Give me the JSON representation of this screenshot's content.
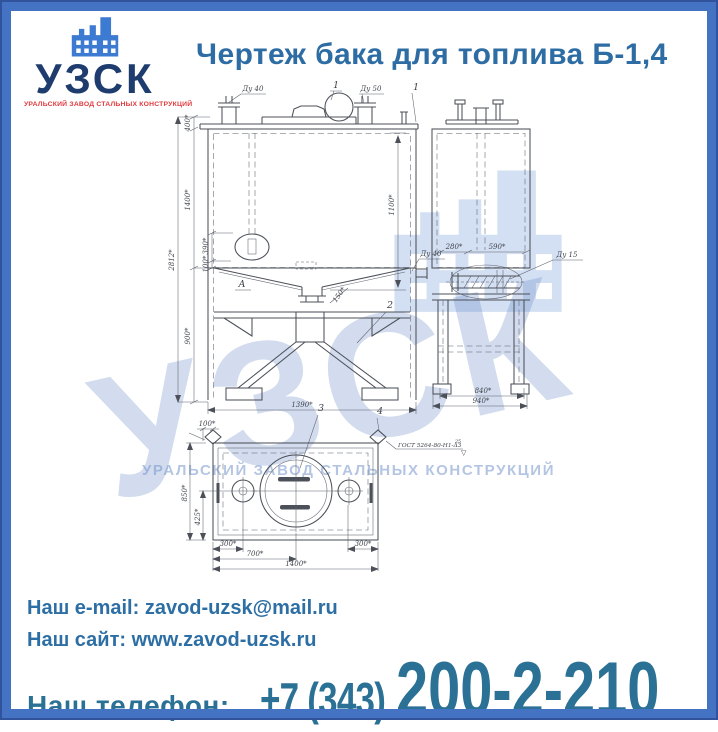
{
  "header": {
    "logo": {
      "abbr": "УЗСК",
      "slogan": "УРАЛЬСКИЙ ЗАВОД СТАЛЬНЫХ КОНСТРУКЦИЙ"
    },
    "title": "Чертеж бака для топлива Б-1,4"
  },
  "watermark": {
    "abbr": "УЗСК",
    "slogan": "УРАЛЬСКИЙ ЗАВОД СТАЛЬНЫХ КОНСТРУКЦИЙ"
  },
  "drawing": {
    "front": {
      "du40_top": "Ду 40",
      "item1_top": "1",
      "du50_top": "Ду 50",
      "item1_right": "1",
      "d400": "400*",
      "d1400": "1400*",
      "d2812": "2812*",
      "d390": "390*",
      "d100": "100*",
      "d900": "900*",
      "d1100": "1100*",
      "du40_right": "Ду 40",
      "d150": "150*",
      "view_a": "А",
      "item2": "2",
      "d1390": "1390*"
    },
    "side": {
      "d280": "280*",
      "d590": "590*",
      "du15": "Ду 15",
      "d840": "840*",
      "d940": "940*"
    },
    "plan": {
      "d100": "100*",
      "d850": "850*",
      "d425": "425*",
      "d300_left": "300*",
      "d700": "700*",
      "d300_right": "300*",
      "d1400": "1400*",
      "item3": "3",
      "item4": "4",
      "weld_note": "ГОСТ 5264-80-Н1-Δ3",
      "weld_value": "25",
      "weld_symbol": "▽"
    }
  },
  "footer": {
    "email_label": "Наш e-mail:",
    "email_value": "zavod-uzsk@mail.ru",
    "site_label": "Наш сайт:",
    "site_value": "www.zavod-uzsk.ru",
    "phone_label": "Наш телефон:",
    "phone_area": "+7 (343)",
    "phone_number": "200-2-210"
  },
  "colors": {
    "frame_blue": "#4573c4",
    "frame_edge": "#31539b",
    "title_blue": "#2e6da4",
    "logo_navy": "#1e3c6e",
    "logo_red": "#e03a3e",
    "logo_icon_blue": "#3d7ad1",
    "contact_blue": "#2d6fa4",
    "phone_blue": "#2a7195",
    "drawing_line": "#4c5058",
    "watermark_blue": "#6a8cc6"
  }
}
